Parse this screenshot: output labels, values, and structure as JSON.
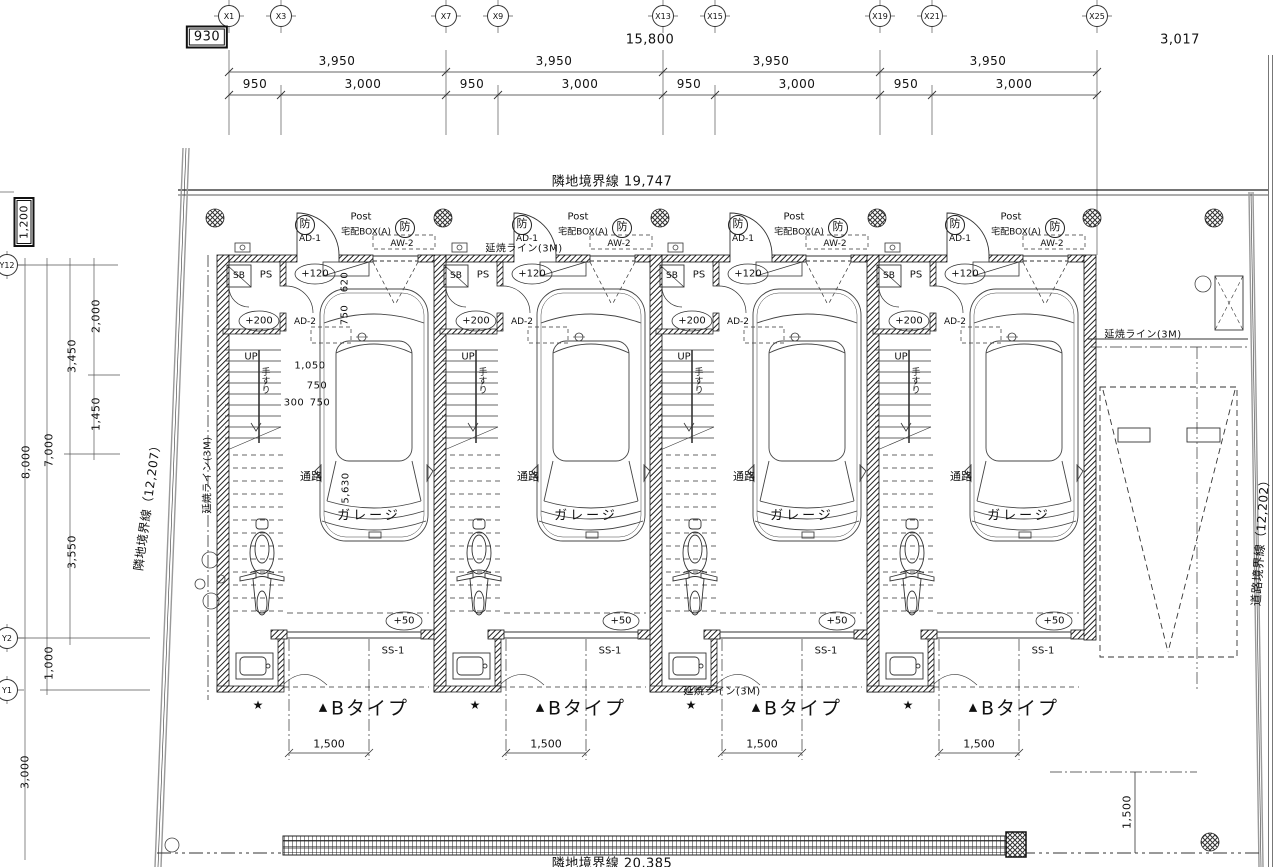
{
  "drawing": {
    "offsets": {
      "top_box": "930",
      "left_box": "1,200"
    },
    "axis_x": [
      "X1",
      "X3",
      "X7",
      "X9",
      "X13",
      "X15",
      "X19",
      "X21",
      "X25"
    ],
    "axis_y": [
      "Y12",
      "Y2",
      "Y1"
    ],
    "top_dims": {
      "total": "15,800",
      "right": "3,017",
      "bay": "3,950",
      "sub_a": "950",
      "sub_b": "3,000"
    },
    "left_dims": {
      "v2000": "2,000",
      "v3450": "3,450",
      "v1450": "1,450",
      "v7000": "7,000",
      "v8000": "8,000",
      "v3550": "3,550",
      "v1000": "1,000",
      "v3000": "3,000"
    },
    "boundaries": {
      "top": "隣地境界線 19,747",
      "left": "隣地境界線（12,207）",
      "right": "道路境界線（12,202）",
      "bottom": "隣地境界線 20,385"
    },
    "fire_lines": {
      "left": "延焼ライン(3M)",
      "top": "延焼ライン(3M)",
      "right": "延焼ライン(3M)",
      "bottom": "延焼ライン(3M)"
    },
    "right_dim_1500": "1,500",
    "unit": {
      "bo": "防",
      "ad1": "AD-1",
      "post": "Post",
      "delivery_box": "宅配BOX(A)",
      "aw2": "AW-2",
      "sb": "SB",
      "ps": "PS",
      "lv_entry": "+120",
      "lv_hall": "+200",
      "ad2": "AD-2",
      "up": "UP",
      "handrail": "手すり",
      "passage": "通路",
      "garage": "ガレージ",
      "lv_garage": "+50",
      "ss1": "SS-1",
      "star": "★",
      "triangle": "▲",
      "type_name": "Bタイプ",
      "front_dim": "1,500"
    },
    "unit1_dims": {
      "d620": "620",
      "d750": "750",
      "d1050": "1,050",
      "d750b": "750",
      "d300": "300",
      "d750c": "750",
      "d5630": "5,630"
    },
    "ink": "#1a1a1a"
  }
}
